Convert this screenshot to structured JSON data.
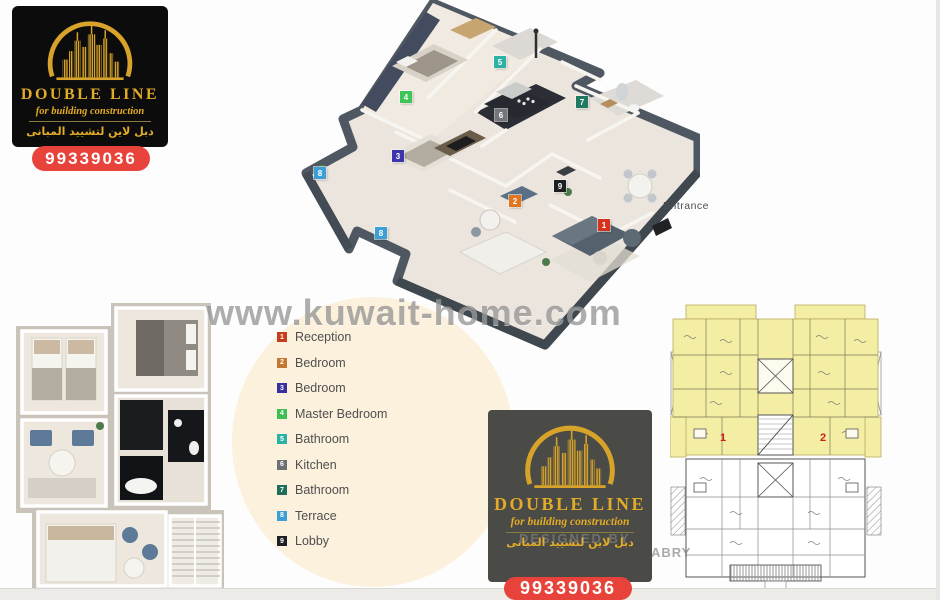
{
  "brand": {
    "name": "DOUBLE LINE",
    "tagline": "for building construction",
    "arabic_name": "دبل لاين لتشييد المبانى",
    "phone": "99339036",
    "colors": {
      "gold": "#D8A32A",
      "red": "#E8433B",
      "box_black": "#0C0C0C",
      "box_gray": "#4A4A46"
    }
  },
  "watermark": {
    "site": "www.kuwait-home.com",
    "designed_by": "DESIGNED BY",
    "designer": "ABRY"
  },
  "plan_3d": {
    "entrance_label": "Entrance",
    "markers": [
      {
        "num": "1",
        "color": "#d6331f",
        "x": 604,
        "y": 225
      },
      {
        "num": "2",
        "color": "#e2761f",
        "x": 515,
        "y": 201
      },
      {
        "num": "3",
        "color": "#3c35ad",
        "x": 398,
        "y": 156
      },
      {
        "num": "4",
        "color": "#3ec457",
        "x": 406,
        "y": 97
      },
      {
        "num": "5",
        "color": "#2cb2a5",
        "x": 500,
        "y": 62
      },
      {
        "num": "6",
        "color": "#73757a",
        "x": 501,
        "y": 115
      },
      {
        "num": "7",
        "color": "#1f7a60",
        "x": 582,
        "y": 102
      },
      {
        "num": "8",
        "color": "#3c9fd6",
        "x": 320,
        "y": 173
      },
      {
        "num": "8",
        "color": "#3c9fd6",
        "x": 381,
        "y": 233
      },
      {
        "num": "9",
        "color": "#1d1f22",
        "x": 560,
        "y": 186
      }
    ]
  },
  "legend": {
    "items": [
      {
        "num": "1",
        "label": "Reception",
        "color": "#c63c1f"
      },
      {
        "num": "2",
        "label": "Bedroom",
        "color": "#c5772f"
      },
      {
        "num": "3",
        "label": "Bedroom",
        "color": "#37309e"
      },
      {
        "num": "4",
        "label": "Master Bedroom",
        "color": "#3fbf52"
      },
      {
        "num": "5",
        "label": "Bathroom",
        "color": "#2cb2a5"
      },
      {
        "num": "6",
        "label": "Kitchen",
        "color": "#6e7073"
      },
      {
        "num": "7",
        "label": "Bathroom",
        "color": "#1e6f59"
      },
      {
        "num": "8",
        "label": "Terrace",
        "color": "#3c9fd6"
      },
      {
        "num": "9",
        "label": "Lobby",
        "color": "#1d1f22"
      }
    ]
  },
  "plan_2d": {
    "unit_numbers": [
      "1",
      "2"
    ],
    "highlight_color": "#f4eda4",
    "unit_number_color": "#cc1f1f"
  }
}
